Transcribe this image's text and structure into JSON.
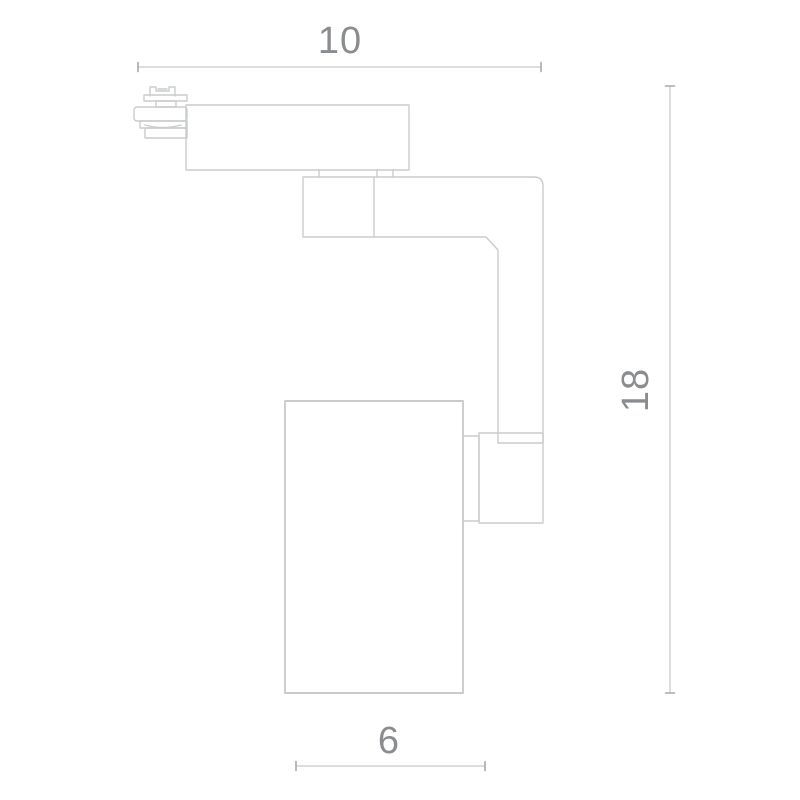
{
  "colors": {
    "background": "#ffffff",
    "line": "#c9ccce",
    "dim-line": "#c6c9cb",
    "dim-tick": "#a6aaad",
    "text": "#8a8d90"
  },
  "dimensions": {
    "top_width": "10",
    "right_height": "18",
    "bottom_width": "6"
  }
}
